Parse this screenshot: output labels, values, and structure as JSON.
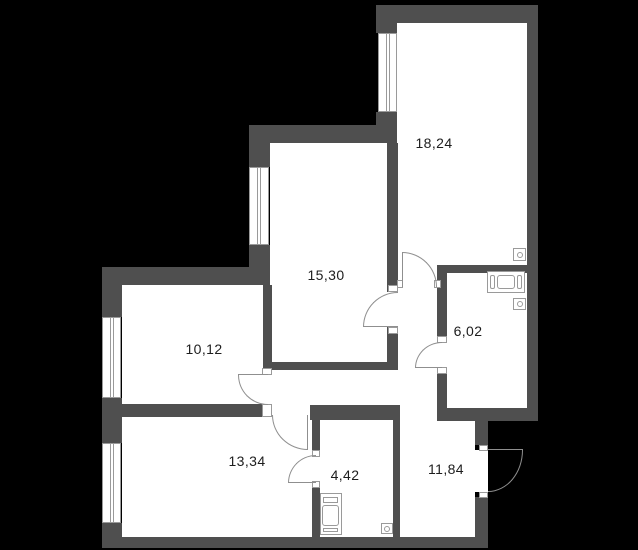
{
  "plan": {
    "type": "apartment-floor-plan",
    "palette": {
      "background": "#000000",
      "wall": "#4f4f4f",
      "room_fill": "#ffffff",
      "symbol_line": "#8f8f8f",
      "label_text": "#1d1d1d"
    },
    "rooms": [
      {
        "label": "18,24"
      },
      {
        "label": "15,30"
      },
      {
        "label": "10,12"
      },
      {
        "label": "6,02"
      },
      {
        "label": "13,34"
      },
      {
        "label": "4,42"
      },
      {
        "label": "11,84"
      }
    ],
    "fixtures": [
      "bathtub-icon",
      "washing-machine-icon",
      "outlet-icon",
      "outlet-icon",
      "outlet-icon"
    ],
    "windows_count": 4,
    "doors_count": 7
  }
}
